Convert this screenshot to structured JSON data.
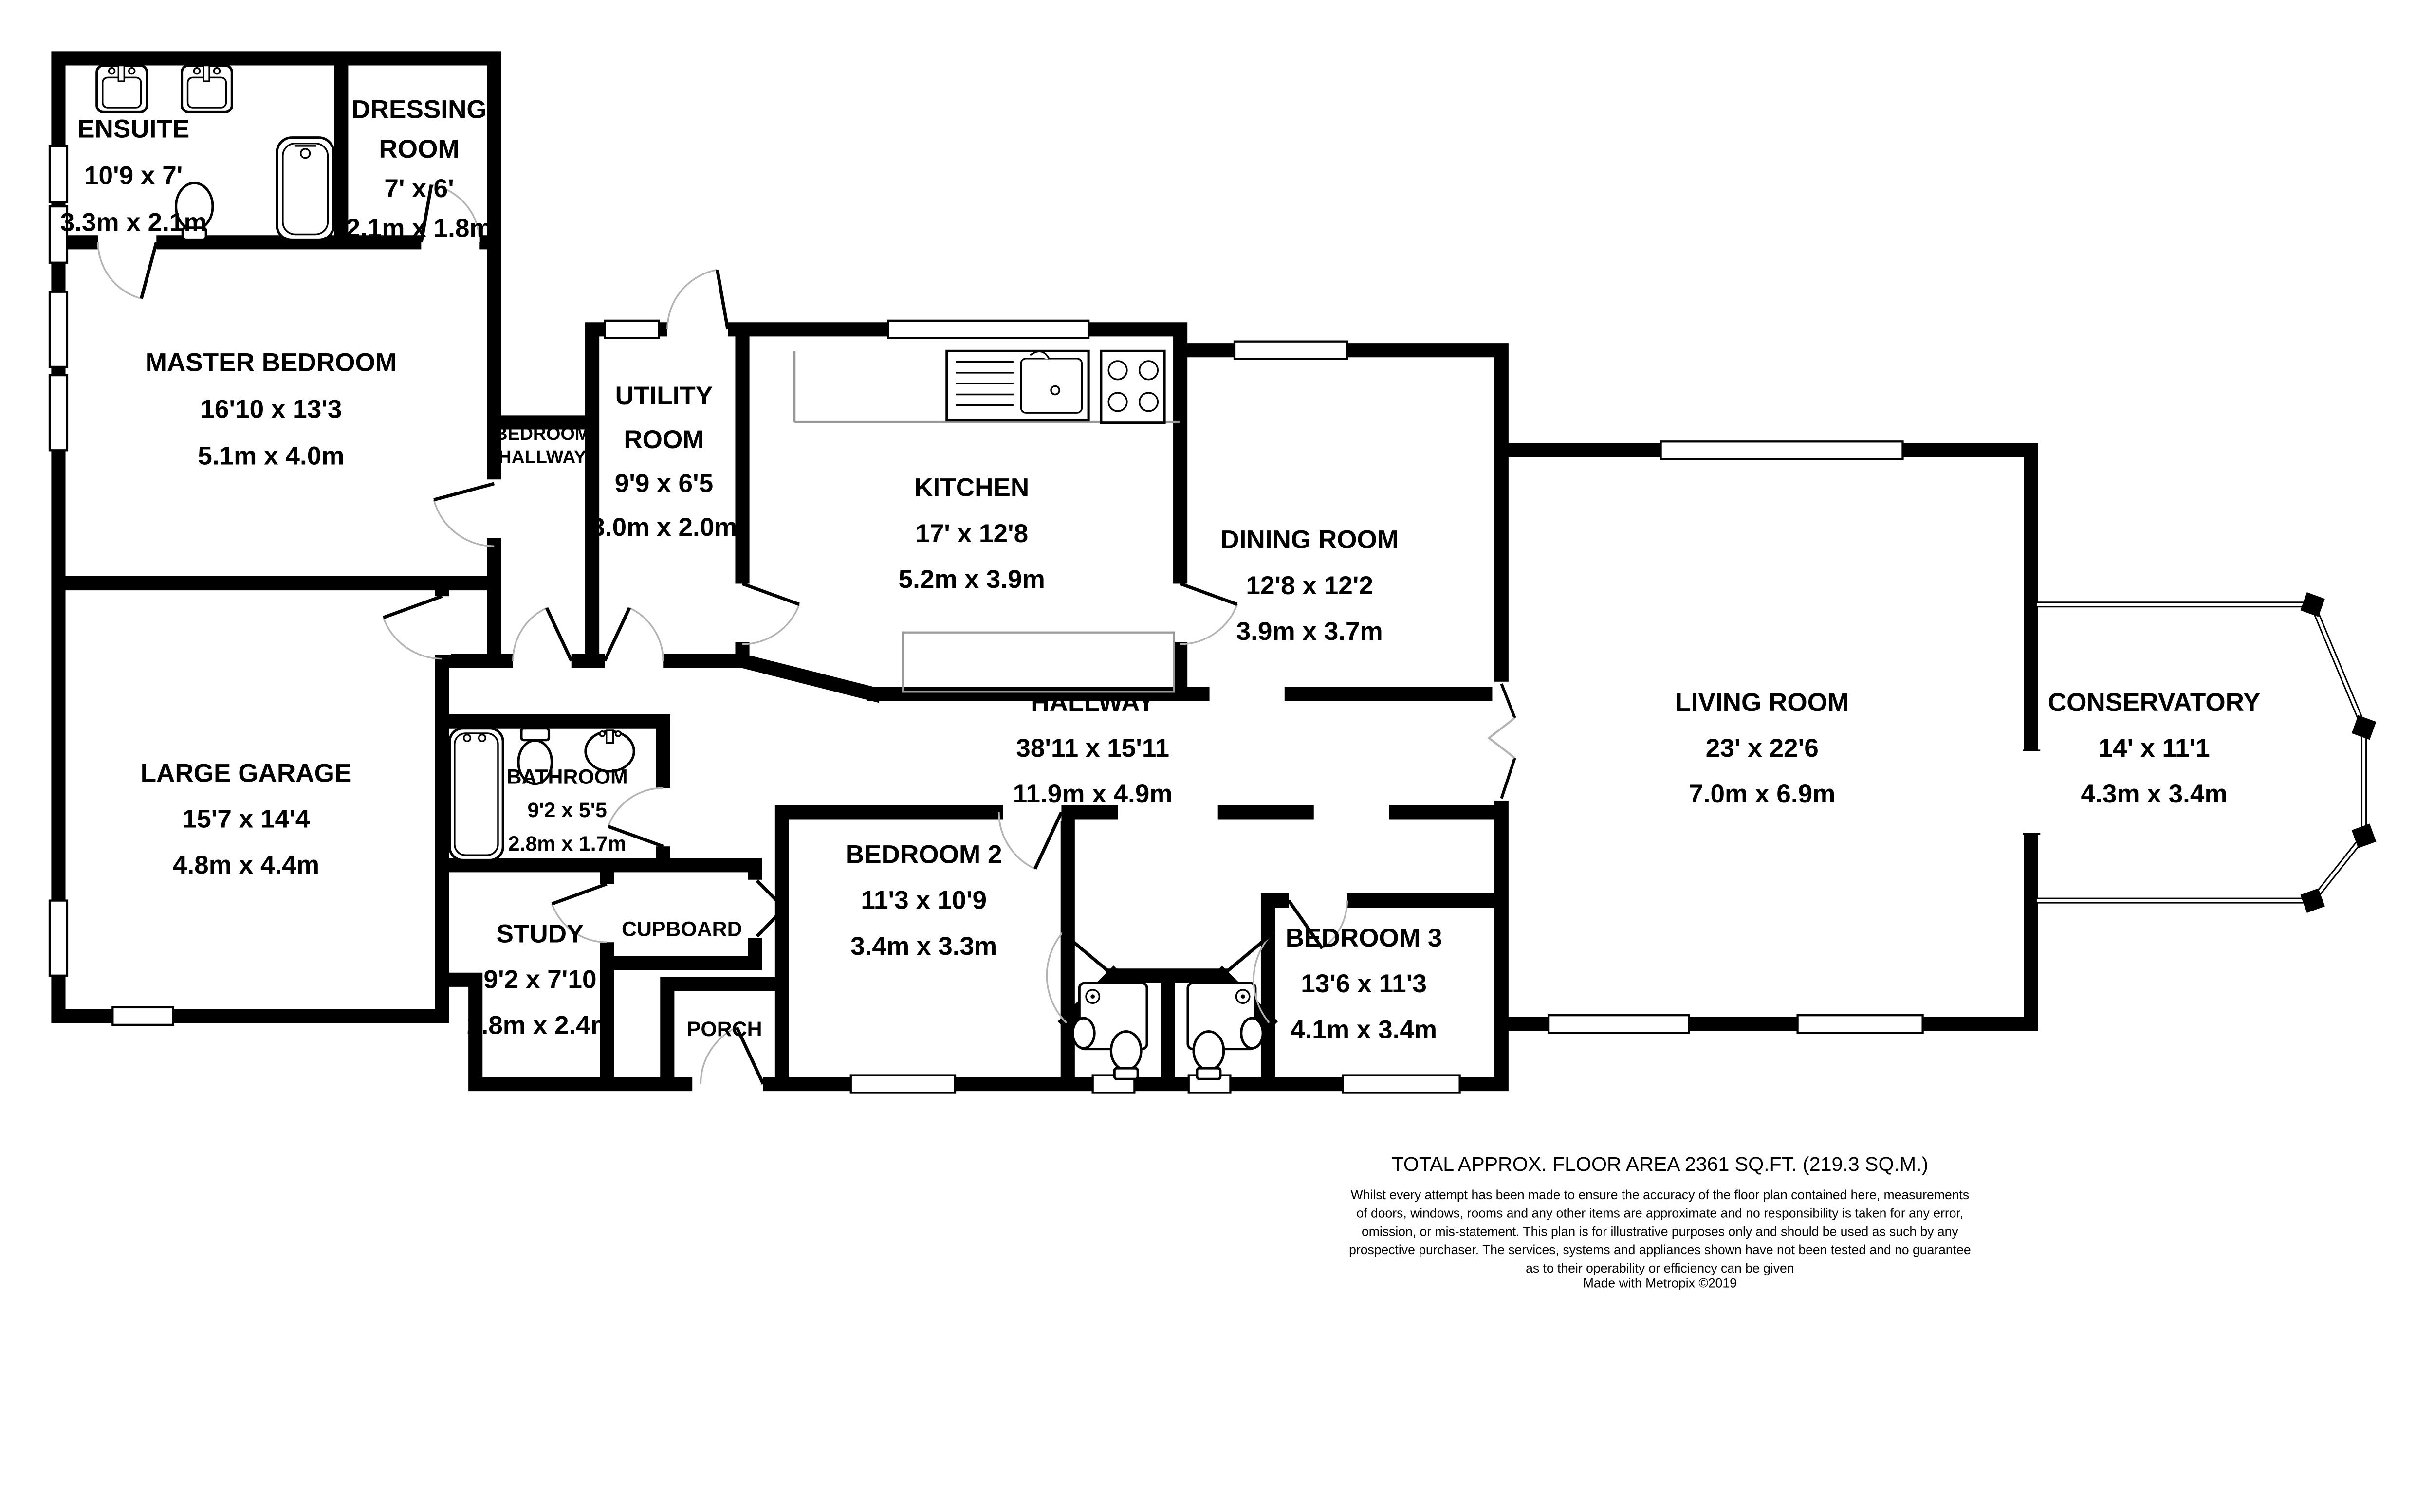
{
  "title": "Bungalow floor plan",
  "colors": {
    "wall": "#000000",
    "background": "#ffffff",
    "counter_outline": "#999999",
    "door_arc": "#b3b3b3",
    "text": "#000000"
  },
  "rooms": [
    {
      "id": "ensuite",
      "lines": [
        "ENSUITE",
        "10'9 x 7'",
        "3.3m x 2.1m"
      ]
    },
    {
      "id": "dressing-room",
      "lines": [
        "DRESSING",
        "ROOM",
        "7' x 6'",
        "2.1m x 1.8m"
      ]
    },
    {
      "id": "master-bedroom",
      "lines": [
        "MASTER BEDROOM",
        "16'10 x 13'3",
        "5.1m x 4.0m"
      ]
    },
    {
      "id": "bedroom-hallway",
      "lines": [
        "BEDROOM",
        "HALLWAY"
      ]
    },
    {
      "id": "utility-room",
      "lines": [
        "UTILITY",
        "ROOM",
        "9'9 x 6'5",
        "3.0m x 2.0m"
      ]
    },
    {
      "id": "kitchen",
      "lines": [
        "KITCHEN",
        "17' x 12'8",
        "5.2m x 3.9m"
      ]
    },
    {
      "id": "dining-room",
      "lines": [
        "DINING ROOM",
        "12'8 x 12'2",
        "3.9m x 3.7m"
      ]
    },
    {
      "id": "hallway",
      "lines": [
        "HALLWAY",
        "38'11 x 15'11",
        "11.9m x 4.9m"
      ]
    },
    {
      "id": "living-room",
      "lines": [
        "LIVING ROOM",
        "23' x 22'6",
        "7.0m x 6.9m"
      ]
    },
    {
      "id": "conservatory",
      "lines": [
        "CONSERVATORY",
        "14' x 11'1",
        "4.3m x 3.4m"
      ]
    },
    {
      "id": "large-garage",
      "lines": [
        "LARGE GARAGE",
        "15'7 x 14'4",
        "4.8m x 4.4m"
      ]
    },
    {
      "id": "bathroom",
      "lines": [
        "BATHROOM",
        "9'2 x 5'5",
        "2.8m x 1.7m"
      ]
    },
    {
      "id": "cupboard",
      "lines": [
        "CUPBOARD"
      ]
    },
    {
      "id": "study",
      "lines": [
        "STUDY",
        "9'2 x 7'10",
        "2.8m x 2.4m"
      ]
    },
    {
      "id": "porch",
      "lines": [
        "PORCH"
      ]
    },
    {
      "id": "bedroom-2",
      "lines": [
        "BEDROOM 2",
        "11'3 x 10'9",
        "3.4m x 3.3m"
      ]
    },
    {
      "id": "bedroom-3",
      "lines": [
        "BEDROOM 3",
        "13'6 x 11'3",
        "4.1m x 3.4m"
      ]
    }
  ],
  "fixtures": {
    "ensuite": [
      "sink-icon",
      "sink-icon",
      "toilet-icon",
      "bath-icon"
    ],
    "kitchen": [
      "kitchen-sink-icon",
      "hob-icon",
      "counter",
      "island-counter"
    ],
    "bathroom": [
      "bath-icon",
      "toilet-icon",
      "sink-icon"
    ],
    "shower-room-left": [
      "shower-icon",
      "toilet-icon",
      "sink-icon"
    ],
    "shower-room-right": [
      "shower-icon",
      "toilet-icon",
      "sink-icon"
    ]
  },
  "footer": {
    "total_area": "TOTAL APPROX. FLOOR AREA 2361 SQ.FT. (219.3 SQ.M.)",
    "disclaimer_lines": [
      "Whilst every attempt has been made to ensure the accuracy of the floor plan contained here, measurements",
      "of doors, windows, rooms and any other items are approximate and no responsibility is taken for any error,",
      "omission, or mis-statement. This plan is for illustrative purposes only and should be used as such by any",
      "prospective purchaser. The services, systems and appliances shown have not been tested and no guarantee",
      "as to their operability or efficiency can be given"
    ],
    "credit": "Made with Metropix ©2019"
  }
}
